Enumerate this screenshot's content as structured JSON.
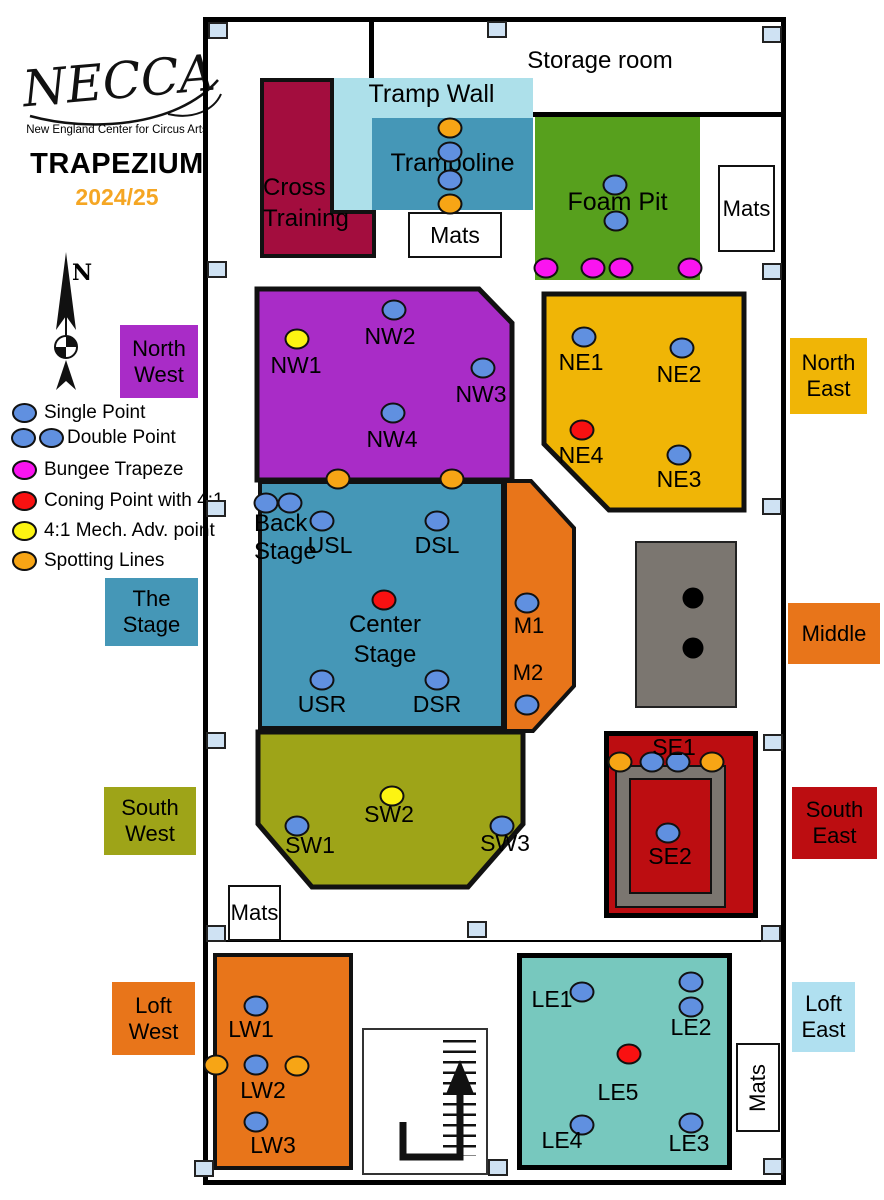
{
  "branding": {
    "logo": "NECCA",
    "tagline": "New England Center for Circus Arts",
    "title": "TRAPEZIUM",
    "season": "2024/25"
  },
  "compass": {
    "north": "N"
  },
  "legend": {
    "items": [
      {
        "label": "Single Point",
        "marker": "single-blue"
      },
      {
        "label": "Double Point",
        "marker": "double-blue"
      },
      {
        "label": "Bungee Trapeze",
        "marker": "magenta"
      },
      {
        "label": "Coning Point with 4:1",
        "marker": "red"
      },
      {
        "label": "4:1 Mech. Adv. point",
        "marker": "yellow"
      },
      {
        "label": "Spotting Lines",
        "marker": "orange"
      }
    ]
  },
  "region_labels": {
    "north_west": {
      "l1": "North",
      "l2": "West"
    },
    "north_east": {
      "l1": "North",
      "l2": "East"
    },
    "the_stage": {
      "l1": "The",
      "l2": "Stage"
    },
    "middle": {
      "l1": "Middle"
    },
    "south_west": {
      "l1": "South",
      "l2": "West"
    },
    "south_east": {
      "l1": "South",
      "l2": "East"
    },
    "loft_west": {
      "l1": "Loft",
      "l2": "West"
    },
    "loft_east": {
      "l1": "Loft",
      "l2": "East"
    }
  },
  "rooms": {
    "storage": "Storage room",
    "tramp_wall": "Tramp Wall",
    "trampoline": "Trampoline",
    "cross_training": {
      "l1": "Cross",
      "l2": "Training"
    },
    "foam_pit": "Foam Pit",
    "mats": "Mats",
    "back_stage": {
      "l1": "Back",
      "l2": "Stage"
    },
    "center_stage": {
      "l1": "Center",
      "l2": "Stage"
    }
  },
  "points": {
    "NW1": "NW1",
    "NW2": "NW2",
    "NW3": "NW3",
    "NW4": "NW4",
    "NE1": "NE1",
    "NE2": "NE2",
    "NE3": "NE3",
    "NE4": "NE4",
    "USL": "USL",
    "DSL": "DSL",
    "USR": "USR",
    "DSR": "DSR",
    "M1": "M1",
    "M2": "M2",
    "SW1": "SW1",
    "SW2": "SW2",
    "SW3": "SW3",
    "SE1": "SE1",
    "SE2": "SE2",
    "LW1": "LW1",
    "LW2": "LW2",
    "LW3": "LW3",
    "LE1": "LE1",
    "LE2": "LE2",
    "LE3": "LE3",
    "LE4": "LE4",
    "LE5": "LE5"
  },
  "colors": {
    "purple_nw": "#A92CC7",
    "amber_ne": "#F0B506",
    "teal_stage": "#4597B7",
    "light_blue_tramp_wall": "#ADE0EA",
    "crimson_cross_training": "#A30D3E",
    "green_foam_pit": "#57A01D",
    "orange_middle": "#E8751A",
    "olive_sw": "#9EA418",
    "dark_red_se": "#BC0D11",
    "teal_loft_east": "#77C8BE",
    "loft_east_label_bg": "#B0E0F0",
    "pillar_blue": "#CFE2F3",
    "point_blue": "#6090E0",
    "point_magenta": "#FA14F0",
    "point_red": "#F91111",
    "point_yellow": "#FCF412",
    "point_orange": "#F7A515",
    "season_orange": "#F5A623"
  }
}
